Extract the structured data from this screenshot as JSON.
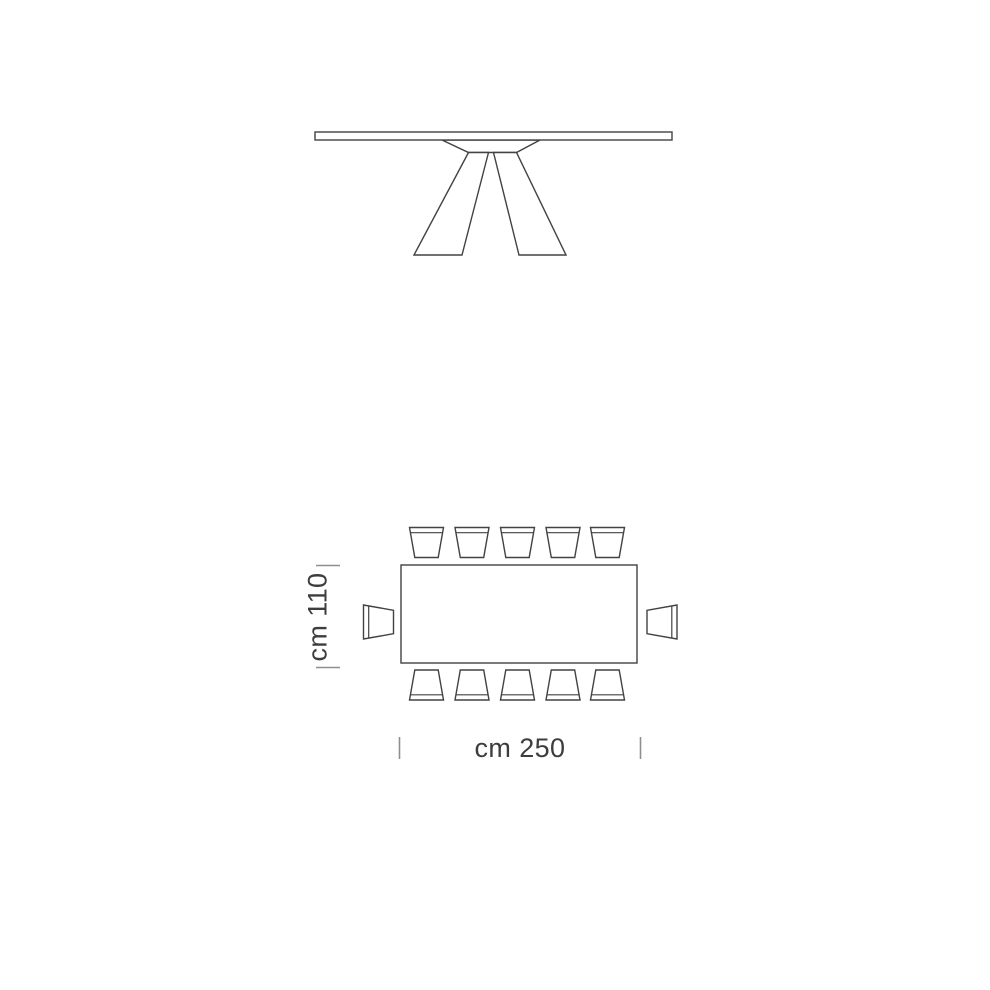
{
  "drawing": {
    "background_color": "#ffffff",
    "line_color": "#424242",
    "tick_color": "#8f8f8f",
    "label_color": "#3d3d3d",
    "views": {
      "front_view": "table front elevation",
      "plan_view": "table top plan with chairs"
    },
    "dimensions": {
      "depth_label": "cm 110",
      "width_label": "cm 250"
    },
    "seating": {
      "chairs_top": 5,
      "chairs_bottom": 5,
      "chairs_left": 1,
      "chairs_right": 1,
      "chairs_total": 12
    }
  }
}
